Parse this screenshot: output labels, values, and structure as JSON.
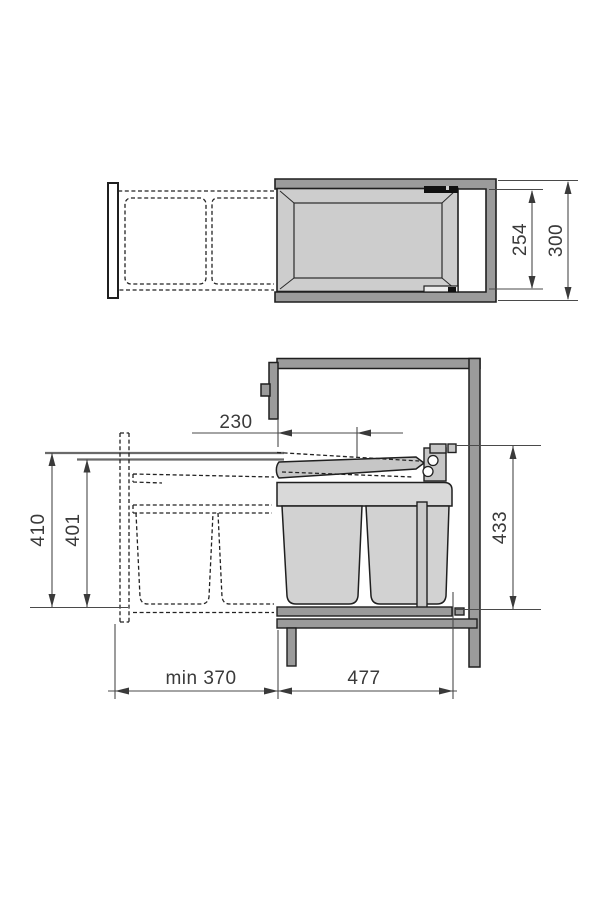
{
  "figure": {
    "kind": "technical-installation-drawing",
    "subject": "pull-out-waste-bin-cabinet-unit",
    "background": "#ffffff",
    "colors": {
      "outline": "#1f1f1f",
      "cabinet_gray": "#9b9b9b",
      "component_gray": "#c6c6c6",
      "tray_gray": "#cdcdcd",
      "bin_gray": "#d2d2d2",
      "platform_gray": "#d9d9d9",
      "guide_line_gray": "#6a6a6a",
      "dimension_line": "#4a4a4a",
      "label_text": "#3a3a3a",
      "rail_black": "#111111"
    }
  },
  "top_view": {
    "dims": {
      "inner": {
        "label": "254"
      },
      "outer": {
        "label": "300"
      }
    }
  },
  "side_view": {
    "dims": {
      "offset": {
        "label": "230"
      },
      "height_outer": {
        "label": "410"
      },
      "height_inner": {
        "label": "401"
      },
      "unit_height": {
        "label": "433"
      },
      "min_depth": {
        "label": "min 370"
      },
      "unit_depth": {
        "label": "477"
      }
    }
  }
}
